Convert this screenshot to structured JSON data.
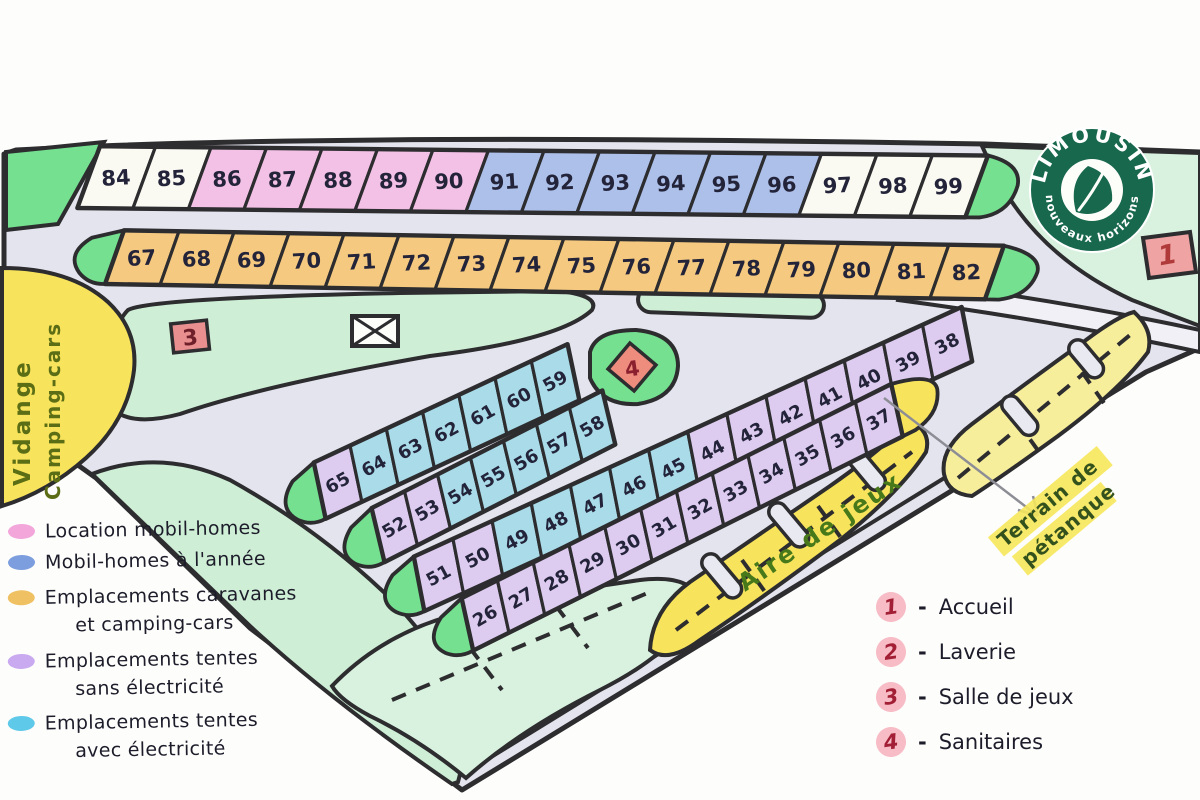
{
  "logo": {
    "brand": "LIMOUSIN",
    "tagline": "nouveaux horizons",
    "color": "#17684d"
  },
  "labels": {
    "vidange_line1": "Vidange",
    "vidange_line2": "Camping-cars",
    "aire_de_jeux": "Aire de jeux",
    "terrain_line1": "Terrain de",
    "terrain_line2": "pétanque"
  },
  "marker_numbers": {
    "m1": "1",
    "m3": "3",
    "m4": "4"
  },
  "legend": {
    "separator": "-",
    "categories": [
      {
        "label": "Location mobil-homes",
        "label2": "",
        "color": "#f2a6da"
      },
      {
        "label": "Mobil-homes à l'année",
        "label2": "",
        "color": "#7d9ede"
      },
      {
        "label": "Emplacements caravanes",
        "label2": "et camping-cars",
        "color": "#efc163"
      },
      {
        "label": "Emplacements tentes",
        "label2": "sans électricité",
        "color": "#c9aaf0"
      },
      {
        "label": "Emplacements tentes",
        "label2": "avec électricité",
        "color": "#5fc9e9"
      }
    ],
    "places": [
      {
        "num": "1",
        "label": "Accueil"
      },
      {
        "num": "2",
        "label": "Laverie"
      },
      {
        "num": "3",
        "label": "Salle de jeux"
      },
      {
        "num": "4",
        "label": "Sanitaires"
      }
    ]
  },
  "cell_colors": {
    "w": "#faf9f2",
    "p": "#f3c1e6",
    "b": "#adc0e9",
    "o": "#f5ca80",
    "u": "#ddccf0",
    "c": "#a9dbe9"
  },
  "map_colors": {
    "road": "#e4e4ee",
    "outline": "#2d2d30",
    "bright_green": "#74e090",
    "light_green": "#cfeed6",
    "pale_green": "#d9f2df",
    "yellow": "#f8e45c",
    "pale_yellow": "#f7ee9c",
    "marker_red": "#f0a3a3",
    "ink": "#23233a"
  },
  "strips": {
    "row1": [
      [
        "84",
        "w"
      ],
      [
        "85",
        "w"
      ],
      [
        "86",
        "p"
      ],
      [
        "87",
        "p"
      ],
      [
        "88",
        "p"
      ],
      [
        "89",
        "p"
      ],
      [
        "90",
        "p"
      ],
      [
        "91",
        "b"
      ],
      [
        "92",
        "b"
      ],
      [
        "93",
        "b"
      ],
      [
        "94",
        "b"
      ],
      [
        "95",
        "b"
      ],
      [
        "96",
        "b"
      ],
      [
        "97",
        "w"
      ],
      [
        "98",
        "w"
      ],
      [
        "99",
        "w"
      ]
    ],
    "row2": [
      [
        "67",
        "o"
      ],
      [
        "68",
        "o"
      ],
      [
        "69",
        "o"
      ],
      [
        "70",
        "o"
      ],
      [
        "71",
        "o"
      ],
      [
        "72",
        "o"
      ],
      [
        "73",
        "o"
      ],
      [
        "74",
        "o"
      ],
      [
        "75",
        "o"
      ],
      [
        "76",
        "o"
      ],
      [
        "77",
        "o"
      ],
      [
        "78",
        "o"
      ],
      [
        "79",
        "o"
      ],
      [
        "80",
        "o"
      ],
      [
        "81",
        "o"
      ],
      [
        "82",
        "o"
      ]
    ],
    "A": [
      [
        "65",
        "u"
      ],
      [
        "64",
        "c"
      ],
      [
        "63",
        "c"
      ],
      [
        "62",
        "c"
      ],
      [
        "61",
        "c"
      ],
      [
        "60",
        "c"
      ],
      [
        "59",
        "c"
      ]
    ],
    "B": [
      [
        "52",
        "u"
      ],
      [
        "53",
        "u"
      ],
      [
        "54",
        "c"
      ],
      [
        "55",
        "c"
      ],
      [
        "56",
        "c"
      ],
      [
        "57",
        "c"
      ],
      [
        "58",
        "c"
      ]
    ],
    "C": [
      [
        "51",
        "u"
      ],
      [
        "50",
        "u"
      ],
      [
        "49",
        "c"
      ],
      [
        "48",
        "c"
      ],
      [
        "47",
        "c"
      ],
      [
        "46",
        "c"
      ],
      [
        "45",
        "c"
      ],
      [
        "44",
        "u"
      ],
      [
        "43",
        "u"
      ],
      [
        "42",
        "u"
      ],
      [
        "41",
        "u"
      ],
      [
        "40",
        "u"
      ],
      [
        "39",
        "u"
      ],
      [
        "38",
        "u"
      ]
    ],
    "D": [
      [
        "26",
        "u"
      ],
      [
        "27",
        "u"
      ],
      [
        "28",
        "u"
      ],
      [
        "29",
        "u"
      ],
      [
        "30",
        "u"
      ],
      [
        "31",
        "u"
      ],
      [
        "32",
        "u"
      ],
      [
        "33",
        "u"
      ],
      [
        "34",
        "u"
      ],
      [
        "35",
        "u"
      ],
      [
        "36",
        "u"
      ],
      [
        "37",
        "u"
      ]
    ]
  }
}
